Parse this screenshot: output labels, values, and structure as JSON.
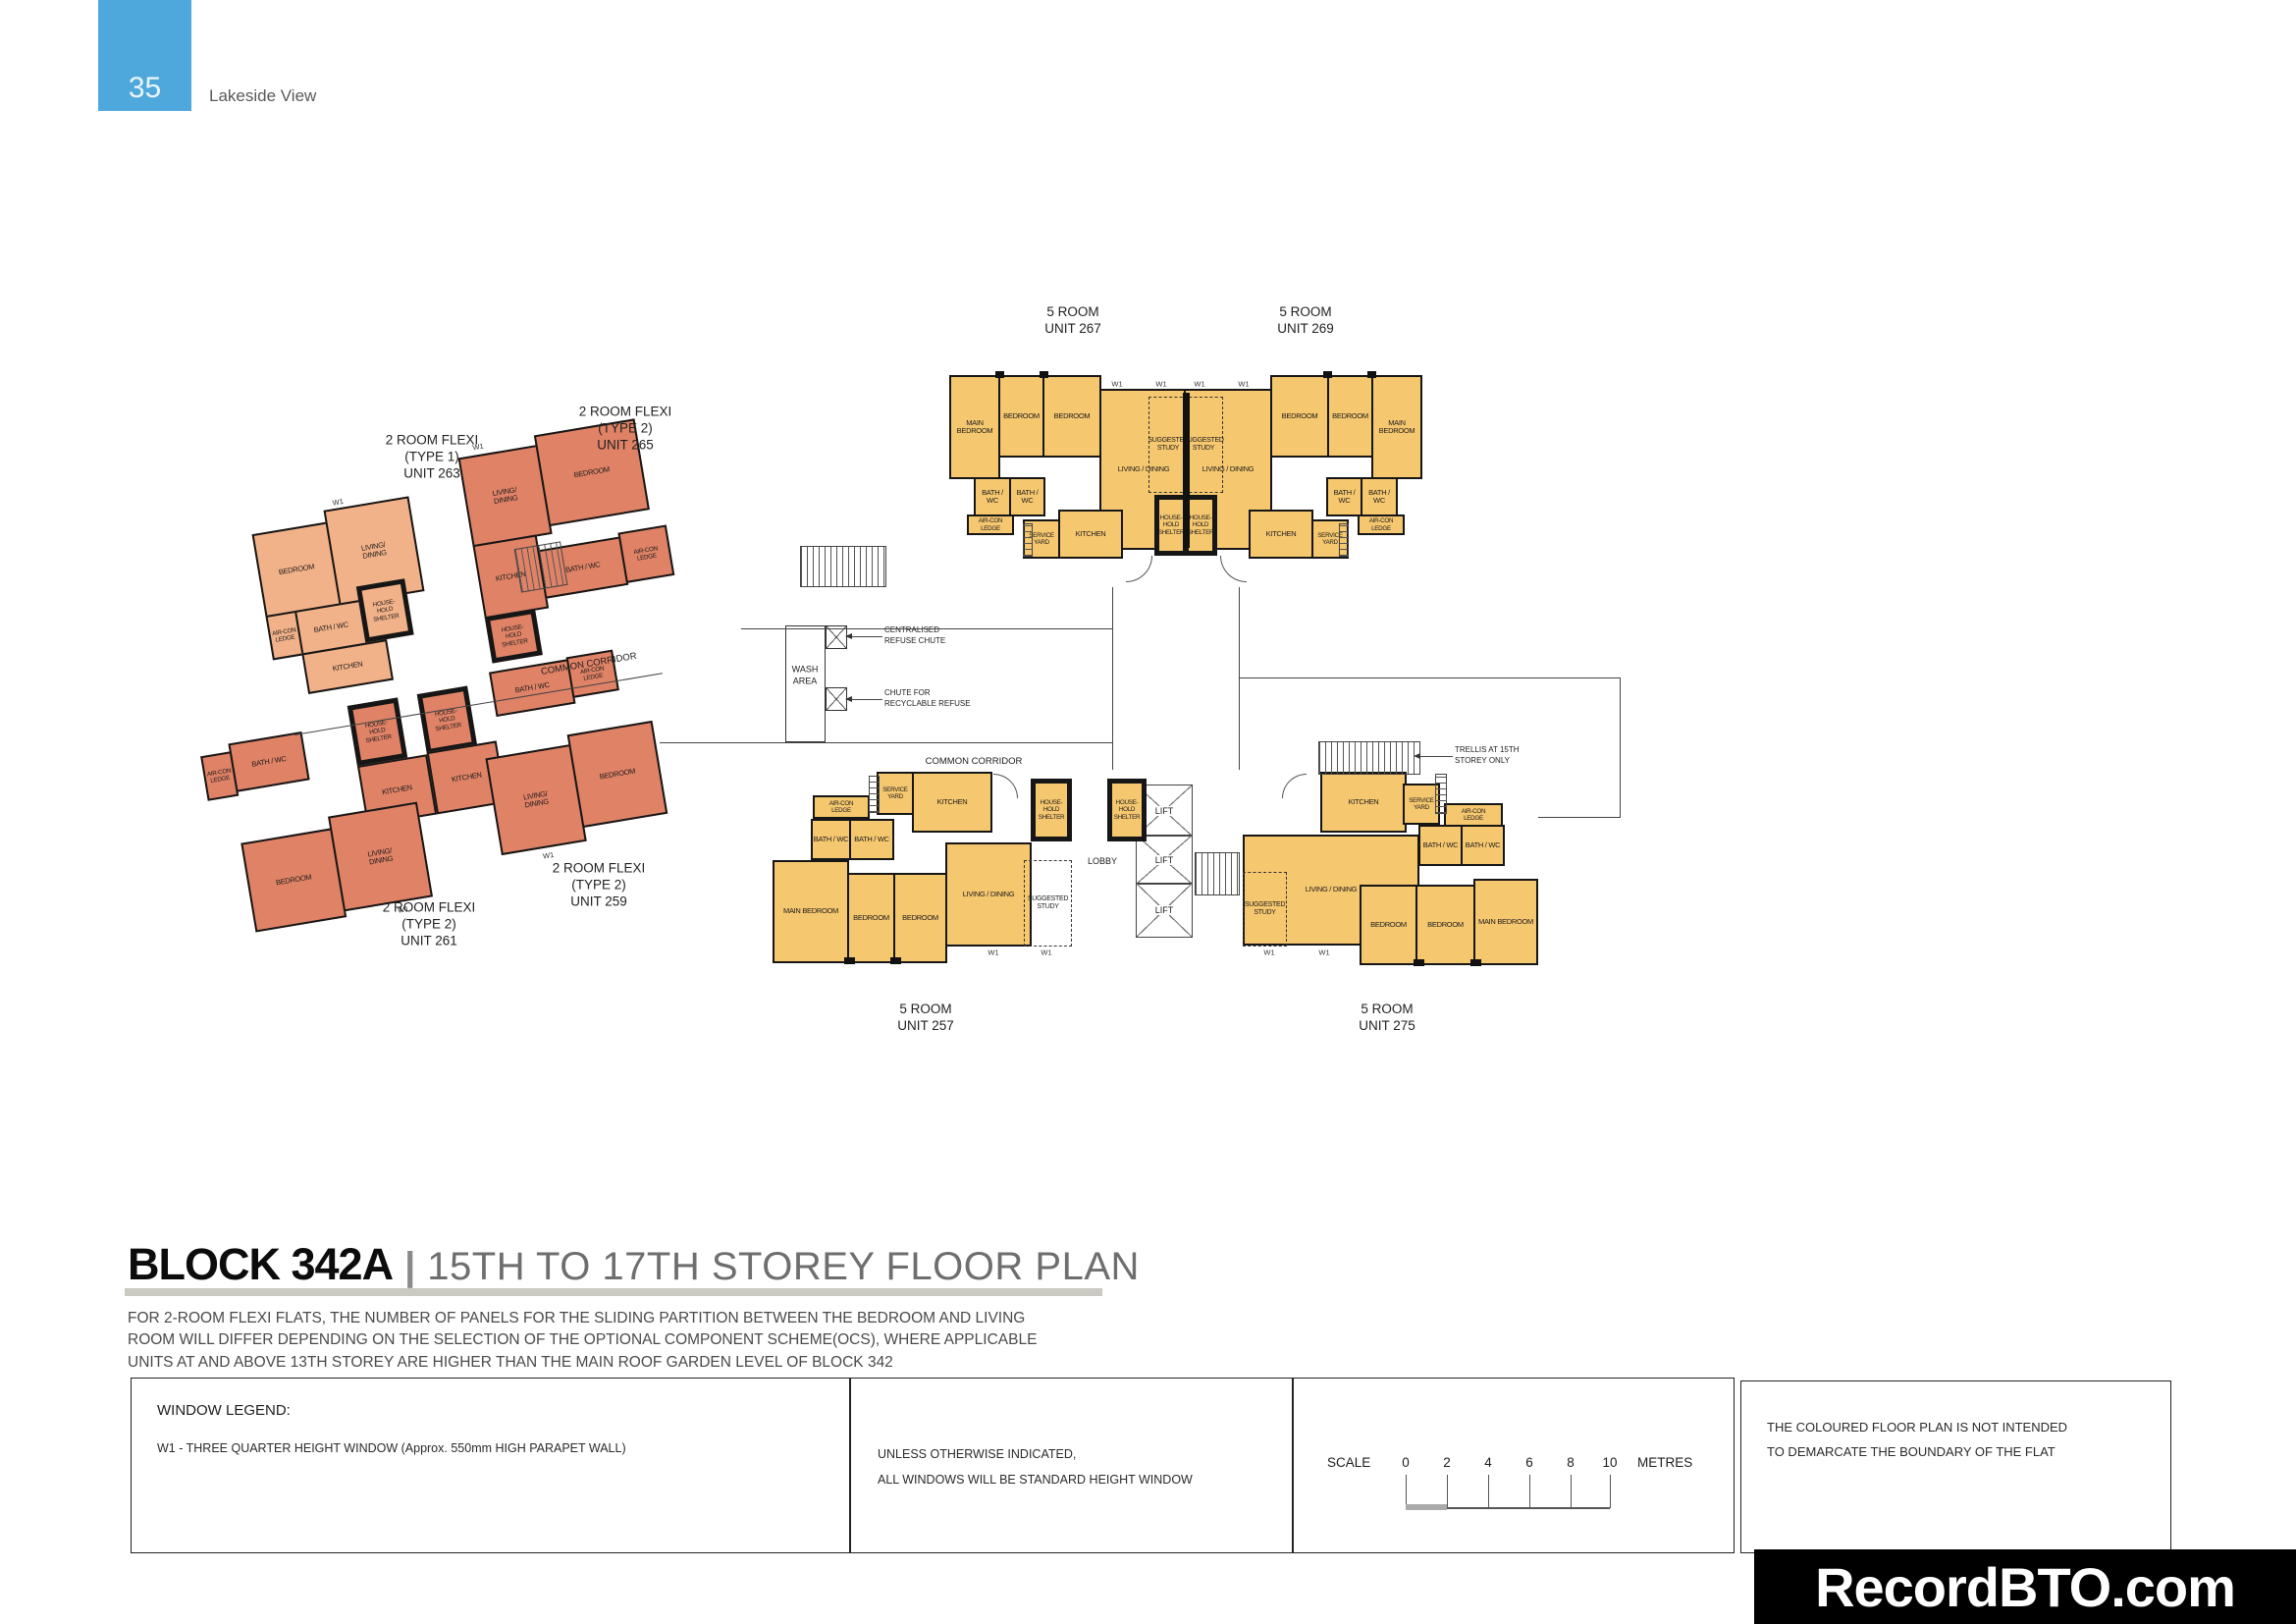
{
  "header": {
    "page_number": "35",
    "project": "Lakeside View"
  },
  "plan": {
    "corridor_label_diagonal": "COMMON CORRIDOR",
    "corridor_label_mid": "COMMON CORRIDOR",
    "wash_area": "WASH\nAREA",
    "chute_centralised": "CENTRALISED\nREFUSE CHUTE",
    "chute_recyclable": "CHUTE FOR\nRECYCLABLE REFUSE",
    "trellis_note": "TRELLIS AT 15TH\nSTOREY ONLY",
    "lobby": "LOBBY",
    "lift": "LIFT",
    "w1": "W1",
    "units": {
      "u267": {
        "name": "5 ROOM\nUNIT 267",
        "rooms": {
          "main_bedroom": "MAIN BEDROOM",
          "bedroom_a": "BEDROOM",
          "bedroom_b": "BEDROOM",
          "living": "LIVING / DINING",
          "study": "SUGGESTED\nSTUDY",
          "bath_a": "BATH / WC",
          "bath_b": "BATH / WC",
          "aircon": "AIR-CON\nLEDGE",
          "service_yard": "SERVICE\nYARD",
          "kitchen": "KITCHEN",
          "shelter": "HOUSE-\nHOLD\nSHELTER"
        }
      },
      "u269": {
        "name": "5 ROOM\nUNIT 269",
        "rooms": {
          "main_bedroom": "MAIN BEDROOM",
          "bedroom_a": "BEDROOM",
          "bedroom_b": "BEDROOM",
          "living": "LIVING / DINING",
          "study": "SUGGESTED\nSTUDY",
          "bath_a": "BATH / WC",
          "bath_b": "BATH / WC",
          "aircon": "AIR-CON\nLEDGE",
          "service_yard": "SERVICE\nYARD",
          "kitchen": "KITCHEN",
          "shelter": "HOUSE-\nHOLD\nSHELTER"
        }
      },
      "u257": {
        "name": "5 ROOM\nUNIT 257",
        "rooms": {
          "main_bedroom": "MAIN BEDROOM",
          "bedroom_a": "BEDROOM",
          "bedroom_b": "BEDROOM",
          "living": "LIVING / DINING",
          "study": "SUGGESTED\nSTUDY",
          "bath_a": "BATH / WC",
          "bath_b": "BATH / WC",
          "aircon": "AIR-CON\nLEDGE",
          "service_yard": "SERVICE\nYARD",
          "kitchen": "KITCHEN",
          "shelter": "HOUSE-\nHOLD\nSHELTER"
        }
      },
      "u275": {
        "name": "5 ROOM\nUNIT 275",
        "rooms": {
          "main_bedroom": "MAIN BEDROOM",
          "bedroom_a": "BEDROOM",
          "bedroom_b": "BEDROOM",
          "living": "LIVING / DINING",
          "study": "SUGGESTED\nSTUDY",
          "bath_a": "BATH / WC",
          "bath_b": "BATH / WC",
          "aircon": "AIR-CON\nLEDGE",
          "service_yard": "SERVICE\nYARD",
          "kitchen": "KITCHEN",
          "shelter": "HOUSE-\nHOLD\nSHELTER"
        }
      },
      "u263": {
        "name": "2 ROOM FLEXI\n(TYPE 1)\nUNIT 263",
        "rooms": {
          "bedroom": "BEDROOM",
          "living": "LIVING/\nDINING",
          "aircon": "AIR-CON\nLEDGE",
          "bath": "BATH / WC",
          "shelter": "HOUSE-\nHOLD\nSHELTER",
          "kitchen": "KITCHEN"
        }
      },
      "u265": {
        "name": "2 ROOM FLEXI\n(TYPE 2)\nUNIT 265",
        "rooms": {
          "living": "LIVING/\nDINING",
          "bedroom": "BEDROOM",
          "kitchen": "KITCHEN",
          "shelter": "HOUSE-\nHOLD\nSHELTER",
          "bath": "BATH / WC",
          "aircon": "AIR-CON\nLEDGE"
        }
      },
      "u261": {
        "name": "2 ROOM FLEXI\n(TYPE 2)\nUNIT 261",
        "rooms": {
          "aircon": "AIR-CON\nLEDGE",
          "bath": "BATH / WC",
          "shelter": "HOUSE-\nHOLD\nSHELTER",
          "kitchen": "KITCHEN",
          "bedroom": "BEDROOM",
          "living": "LIVING/\nDINING"
        }
      },
      "u259": {
        "name": "2 ROOM FLEXI\n(TYPE 2)\nUNIT 259",
        "rooms": {
          "shelter": "HOUSE-\nHOLD\nSHELTER",
          "kitchen": "KITCHEN",
          "bath": "BATH / WC",
          "aircon": "AIR-CON\nLEDGE",
          "living": "LIVING/\nDINING",
          "bedroom": "BEDROOM"
        }
      }
    }
  },
  "title": {
    "block": "BLOCK 342A",
    "divider": "|",
    "storey": "15TH TO 17TH STOREY FLOOR PLAN"
  },
  "notes": "FOR 2-ROOM FLEXI FLATS, THE NUMBER OF PANELS FOR THE SLIDING PARTITION  BETWEEN THE BEDROOM AND LIVING\nROOM WILL DIFFER DEPENDING ON THE SELECTION OF THE OPTIONAL COMPONENT SCHEME(OCS), WHERE APPLICABLE\nUNITS AT AND ABOVE 13TH STOREY ARE HIGHER THAN THE MAIN ROOF GARDEN LEVEL OF BLOCK 342",
  "legend": {
    "title": "WINDOW LEGEND:",
    "w1_text": "W1 - THREE QUARTER HEIGHT WINDOW (Approx. 550mm HIGH PARAPET WALL)",
    "unless": "UNLESS OTHERWISE INDICATED,\nALL WINDOWS WILL BE STANDARD HEIGHT WINDOW"
  },
  "scalebar": {
    "label": "SCALE",
    "ticks": [
      "0",
      "2",
      "4",
      "6",
      "8",
      "10"
    ],
    "unit": "METRES"
  },
  "boundary_note": "THE COLOURED FLOOR PLAN IS NOT INTENDED\nTO DEMARCATE THE BOUNDARY OF THE FLAT",
  "watermark": "RecordBTO.com",
  "colors": {
    "five_room": "#F5C76F",
    "two_room_type1": "#F2B289",
    "two_room_type2": "#DF8266",
    "accent_blue": "#4FA8DC"
  }
}
